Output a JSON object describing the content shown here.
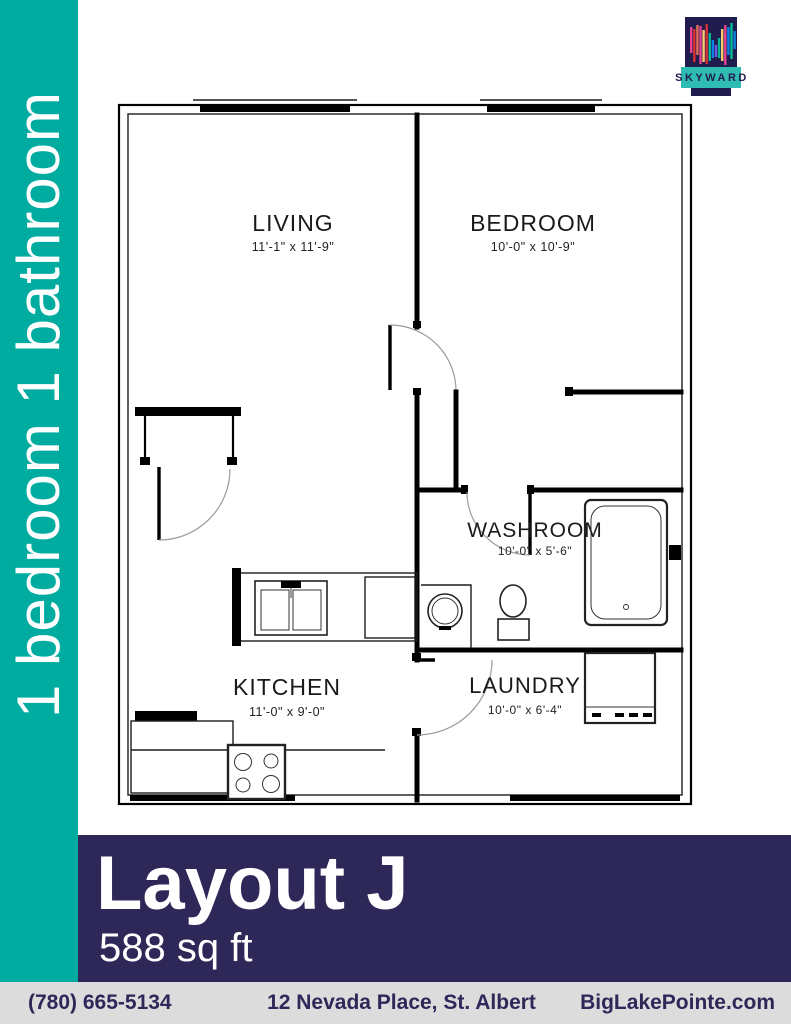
{
  "sidebar": {
    "label": "1 bedroom 1 bathroom"
  },
  "logo": {
    "brand": "SKYWARD"
  },
  "floor_plan": {
    "rooms": [
      {
        "name": "LIVING",
        "dims": "11'-1\" x 11'-9\""
      },
      {
        "name": "BEDROOM",
        "dims": "10'-0\" x 10'-9\""
      },
      {
        "name": "WASHROOM",
        "dims": "10'-0\" x 5'-6\""
      },
      {
        "name": "KITCHEN",
        "dims": "11'-0\" x 9'-0\""
      },
      {
        "name": "LAUNDRY",
        "dims": "10'-0\" x 6'-4\""
      }
    ]
  },
  "banner": {
    "title": "Layout J",
    "subtitle": "588 sq ft"
  },
  "footer": {
    "phone": "(780) 665-5134",
    "address": "12 Nevada Place, St. Albert",
    "website": "BigLakePointe.com"
  },
  "colors": {
    "teal": "#00aba0",
    "navy": "#2e2859",
    "footer_bg": "#dcdcdc",
    "logo_navy": "#211c4e",
    "logo_teal": "#2fbdb3"
  }
}
